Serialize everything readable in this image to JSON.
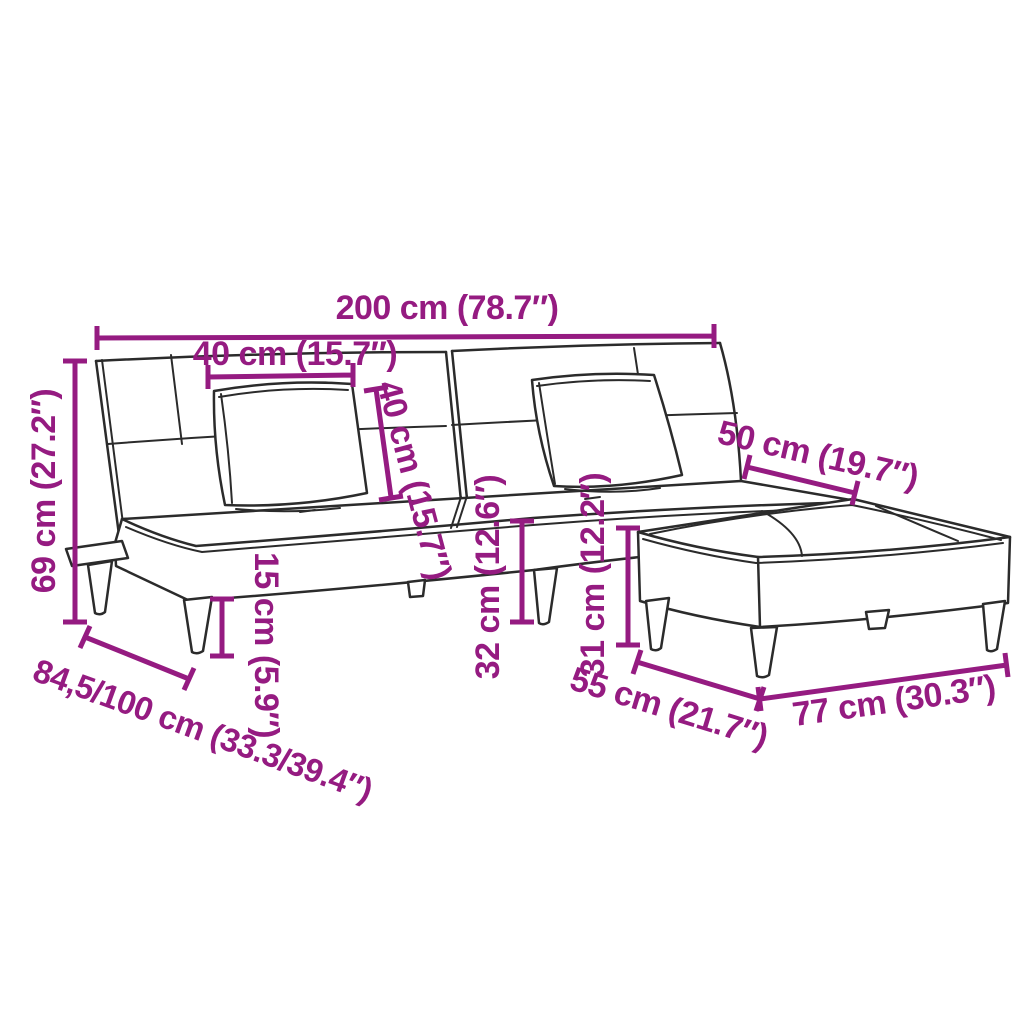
{
  "labels": {
    "total_width": "200 cm (78.7″)",
    "pillow_width": "40 cm (15.7″)",
    "pillow_height": "40 cm (15.7″)",
    "total_height": "69 cm (27.2″)",
    "seat_extension": "50 cm (19.7″)",
    "leg_height": "15 cm (5.9″)",
    "seat_height": "32 cm (12.6″)",
    "ottoman_height": "31 cm (12.2″)",
    "depth_range": "84,5/100 cm (33.3/39.4″)",
    "ottoman_depth": "55 cm (21.7″)",
    "ottoman_width": "77 cm (30.3″)"
  },
  "colors": {
    "dimension": "#951b81",
    "outline": "#2b2b2b",
    "background": "#ffffff"
  }
}
